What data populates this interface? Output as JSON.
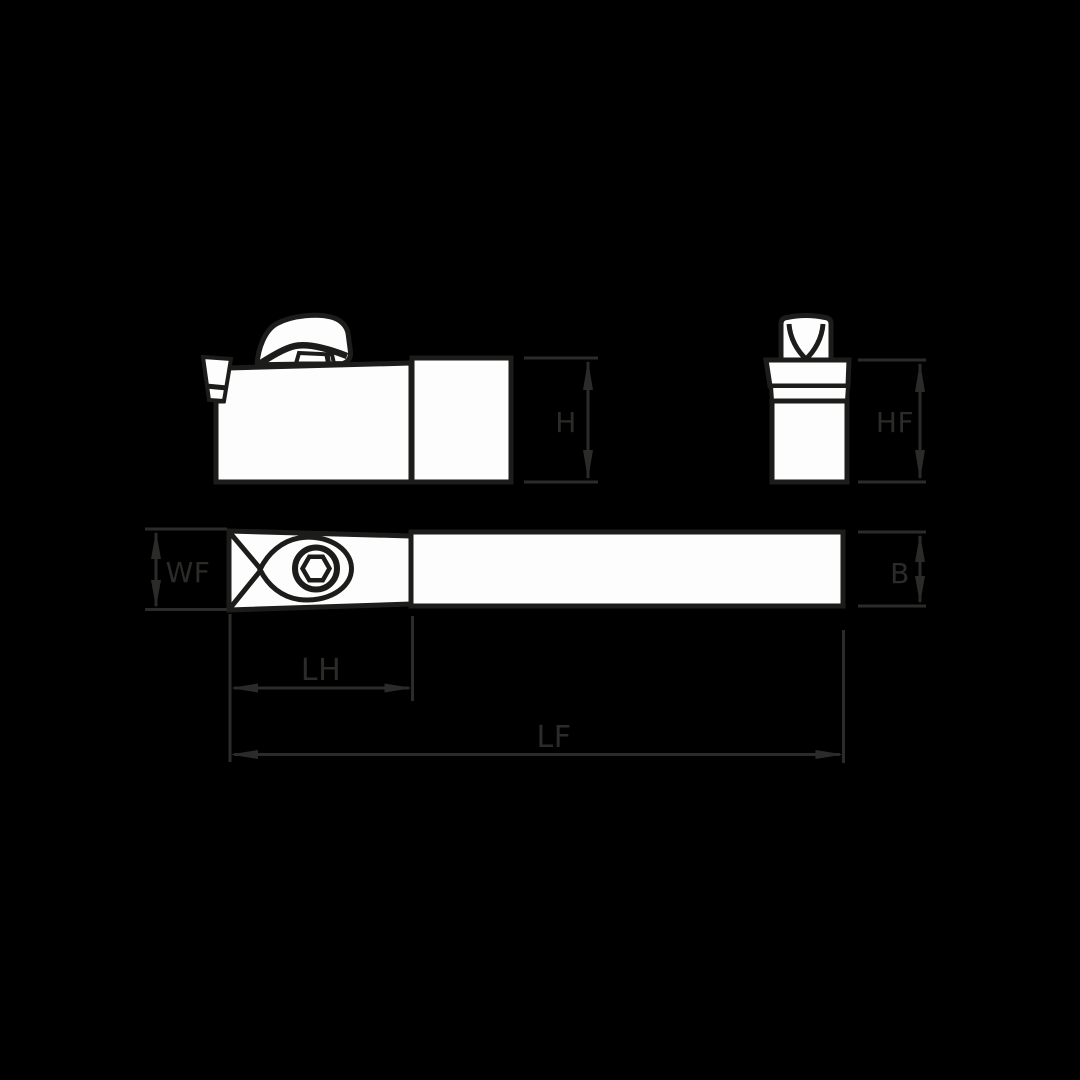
{
  "diagram": {
    "type": "technical-orthographic-drawing",
    "subject": "tool-holder-with-clamp",
    "colors": {
      "background": "#000000",
      "part_fill": "#fdfdfd",
      "part_outline": "#1c1c1a",
      "dimension": "#2b2b29"
    },
    "labels": {
      "H": "H",
      "HF": "HF",
      "WF": "WF",
      "B": "B",
      "LH": "LH",
      "LF": "LF"
    }
  }
}
